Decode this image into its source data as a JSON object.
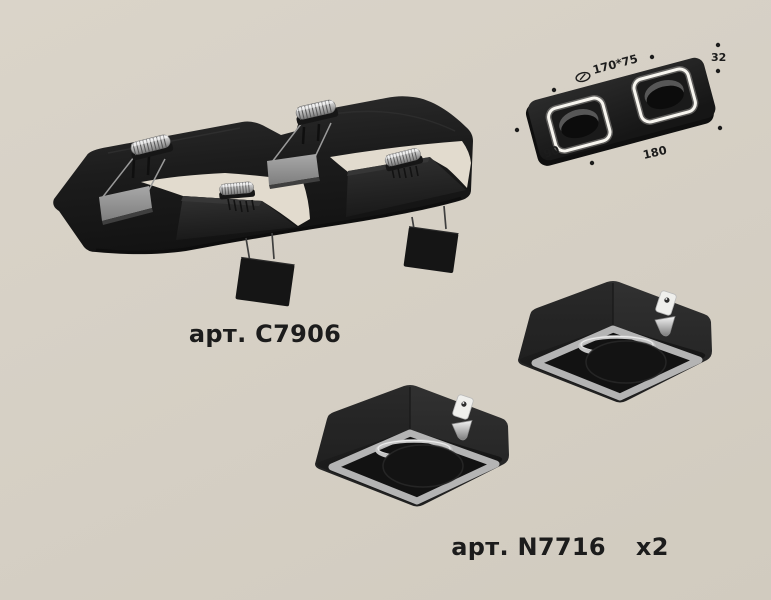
{
  "page": {
    "background_color": "#d6d0c5",
    "description_icons": [
      "recessed-downlight-frame",
      "square-trim-module",
      "dimension-diagram"
    ]
  },
  "products": {
    "main": {
      "sku_label": "арт. C7906"
    },
    "accessory": {
      "sku_label": "арт. N7716",
      "quantity_label": "x2"
    }
  },
  "dimension_diagram": {
    "cutout_size_label": "170*75",
    "height_label": "32",
    "width_label": "90",
    "length_label": "180",
    "cutout_icon": "ceiling-cutout-icon"
  },
  "colors": {
    "text": "#1c1c1c",
    "product_black": "#1f1f1f",
    "metal_silver": "#d9d9d9",
    "retainer_gray": "#8f8f8f",
    "trim_ring_gray": "#b4b4b4",
    "light_ring_white": "#f7f5ef",
    "background": "#d6d0c5"
  }
}
